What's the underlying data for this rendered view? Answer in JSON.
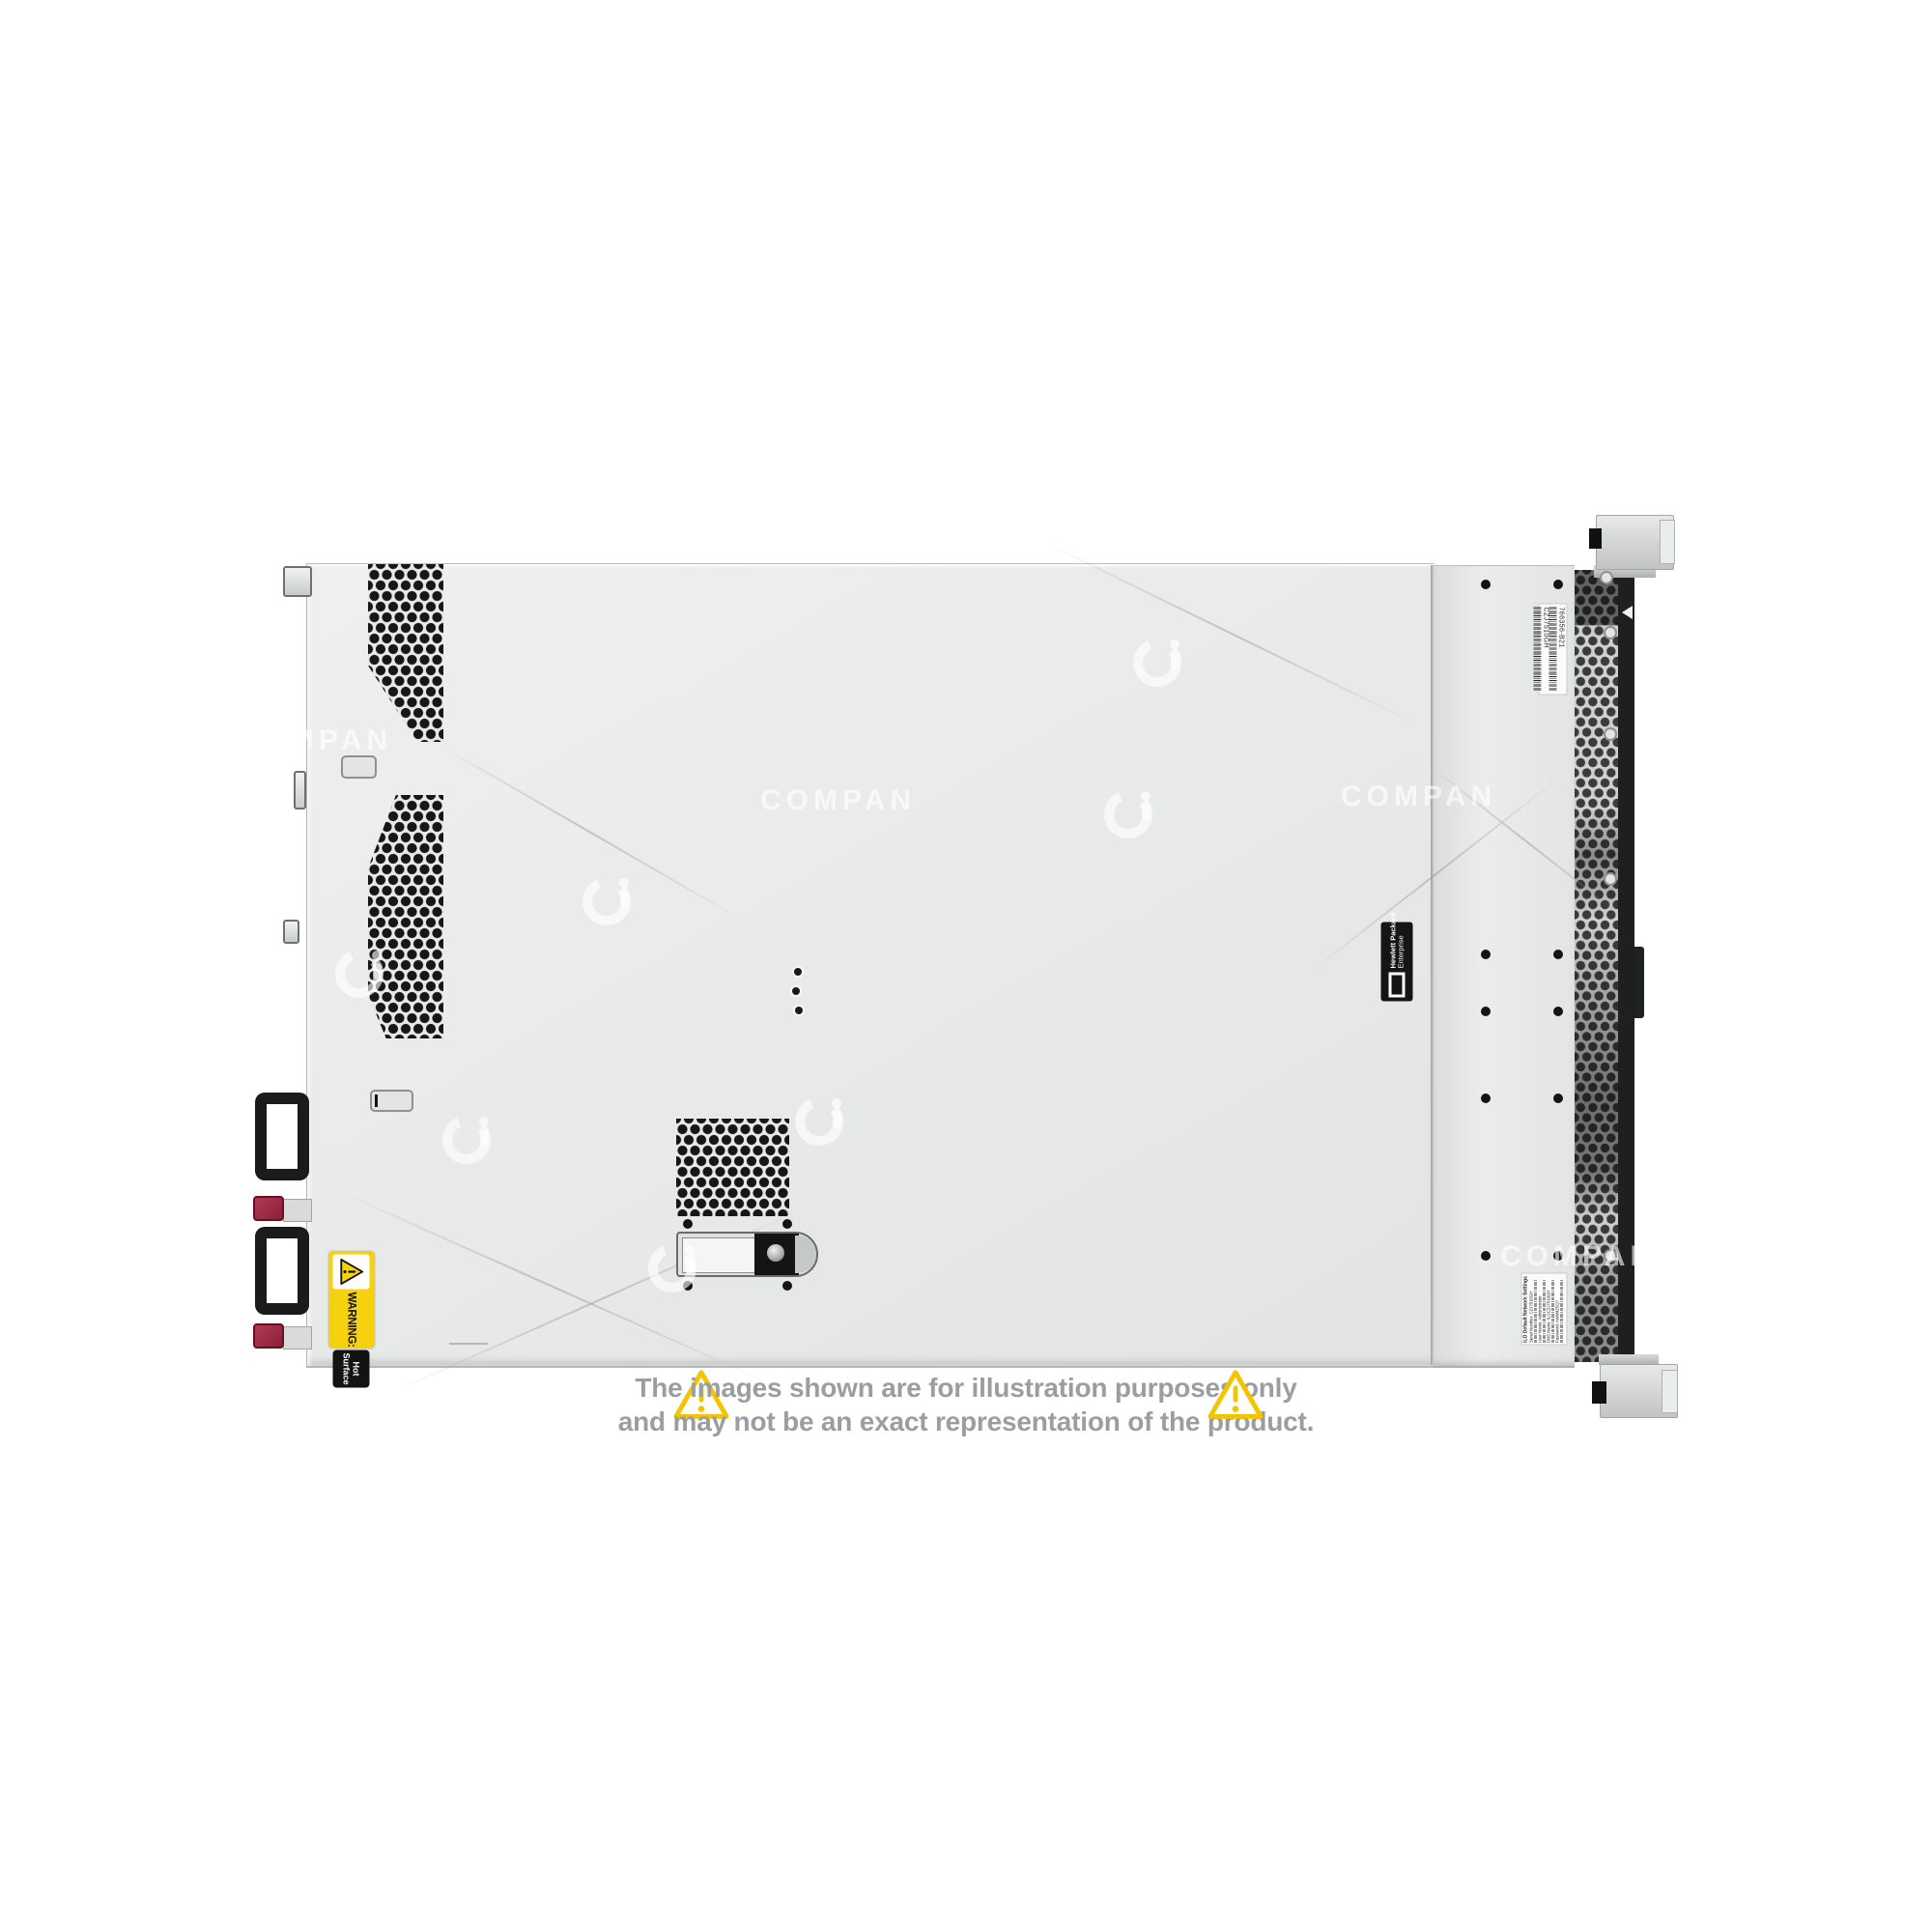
{
  "watermark": {
    "text": "COMPAN"
  },
  "disclaimer": {
    "line1": "The images shown are for illustration purposes only",
    "line2": "and may not be an exact representation of the product."
  },
  "labels": {
    "hpe": {
      "line1": "Hewlett Packard",
      "line2": "Enterprise"
    },
    "warning": {
      "title": "WARNING:",
      "subtitle": "Hot Surface"
    },
    "serial": {
      "part_number": "766356-B21",
      "serial_number": "CZJ7510GH"
    },
    "ilo": {
      "title": "iLO Default Network Settings",
      "rows": [
        "Serial Number: CZJ7510GH",
        "User Name: Administrator",
        "DNS Name: ILOCZJ7510GH",
        "Password: AWM4Z5Q7"
      ]
    }
  },
  "colors": {
    "chassis_gray": "#e9ebeb",
    "bezel_black": "#1e1f20",
    "latch_red": "#9c2742",
    "label_yellow": "#f6d20e",
    "accent_yellow": "#f3c400",
    "disclaimer_text": "#9b9ea1"
  }
}
